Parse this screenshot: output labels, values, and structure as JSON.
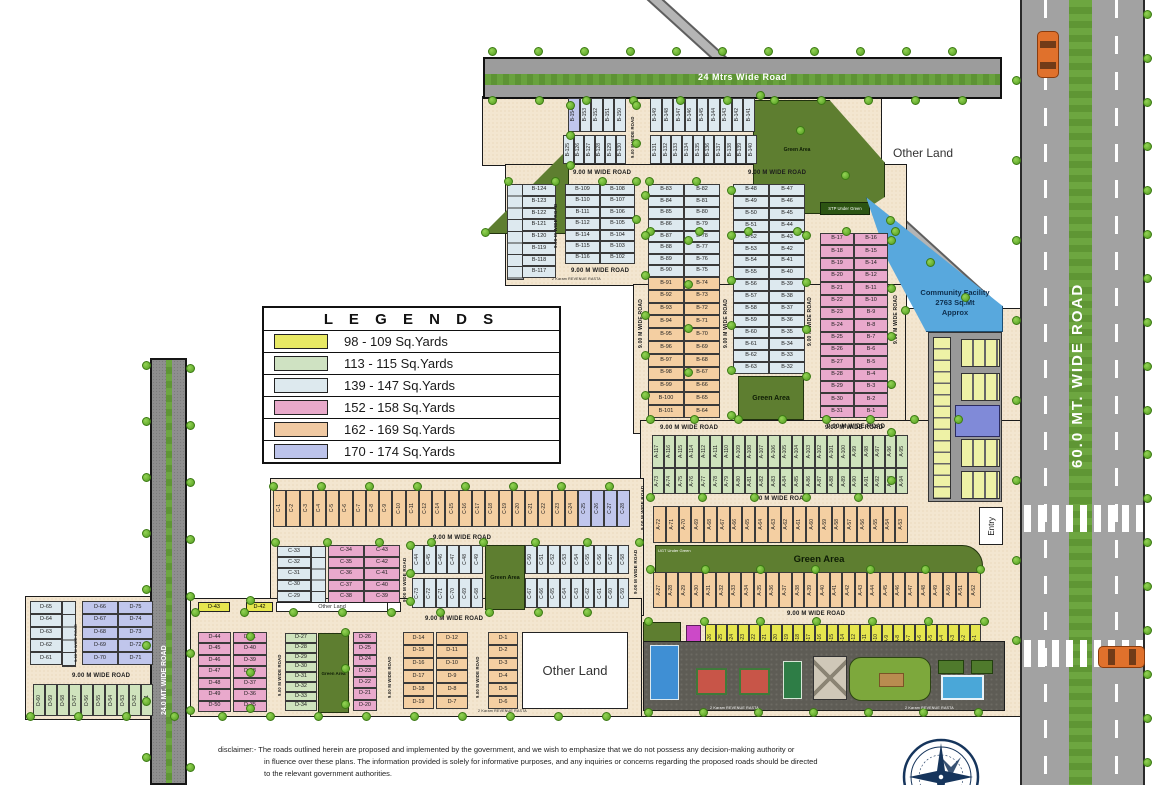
{
  "legend": {
    "title": "L E G E N D S",
    "items": [
      {
        "color": "#e8e964",
        "label": "98 - 109 Sq.Yards"
      },
      {
        "color": "#cfe2c2",
        "label": "113 - 115 Sq.Yards"
      },
      {
        "color": "#dde9ee",
        "label": "139 - 147  Sq.Yards"
      },
      {
        "color": "#e8a9ca",
        "label": "152 - 158  Sq.Yards"
      },
      {
        "color": "#f0c9a2",
        "label": "162 - 169  Sq.Yards"
      },
      {
        "color": "#bcc3ea",
        "label": "170 - 174  Sq.Yards"
      }
    ]
  },
  "roads": {
    "top": "24 Mtrs Wide Road",
    "right": "60.0 MT. WIDE ROAD",
    "left": "24.0 MT. WIDE ROAD",
    "nine_m": "9.00 M WIDE ROAD",
    "rasta": "2 Karam REVENUE RASTA"
  },
  "labels": {
    "other_land": "Other Land",
    "green_area": "Green Area",
    "stp": "STP Under Green",
    "ugt": "UGT Under Green",
    "entry": "Entry",
    "community_l1": "Community Facility",
    "community_l2": "2763 Sq.Mt",
    "community_l3": "Approx"
  },
  "blocks": {
    "b": {
      "row1_left": [
        "B-154",
        "B-153",
        "B-152",
        "B-151",
        "B-150"
      ],
      "row1_right": [
        "B-149",
        "B-148",
        "B-147",
        "B-146",
        "B-145",
        "B-144",
        "B-143",
        "B-142",
        "B-141"
      ],
      "row2_left": [
        "B-125",
        "B-126",
        "B-127",
        "B-128",
        "B-129",
        "B-130"
      ],
      "row2_right": [
        "B-131",
        "B-132",
        "B-133",
        "B-134",
        "B-135",
        "B-136",
        "B-137",
        "B-138",
        "B-139",
        "B-140"
      ],
      "col_outer": [
        "B-124",
        "B-123",
        "B-122",
        "B-121",
        "B-120",
        "B-119",
        "B-118",
        "B-117"
      ],
      "col1_left": [
        "B-109",
        "B-110",
        "B-111",
        "B-112",
        "B-114",
        "B-115",
        "B-116"
      ],
      "col1_right": [
        "B-108",
        "B-107",
        "B-106",
        "B-105",
        "B-104",
        "B-103",
        "B-102"
      ],
      "col2a_left": [
        "B-83",
        "B-84",
        "B-85",
        "B-86",
        "B-87",
        "B-88",
        "B-89",
        "B-90"
      ],
      "col2a_right": [
        "B-82",
        "B-81",
        "B-80",
        "B-79",
        "B-78",
        "B-77",
        "B-76",
        "B-75"
      ],
      "col2b_left": [
        "B-91",
        "B-92",
        "B-93",
        "B-94",
        "B-95",
        "B-96",
        "B-97",
        "B-98",
        "B-99",
        "B-100",
        "B-101"
      ],
      "col2b_right": [
        "B-74",
        "B-73",
        "B-72",
        "B-71",
        "B-70",
        "B-69",
        "B-68",
        "B-67",
        "B-66",
        "B-65",
        "B-64"
      ],
      "col3_left": [
        "B-48",
        "B-49",
        "B-50",
        "B-51",
        "B-52",
        "B-53",
        "B-54",
        "B-55",
        "B-56",
        "B-57",
        "B-58",
        "B-59",
        "B-60",
        "B-61",
        "B-62",
        "B-63"
      ],
      "col3_right": [
        "B-47",
        "B-46",
        "B-45",
        "B-44",
        "B-43",
        "B-42",
        "B-41",
        "B-40",
        "B-39",
        "B-38",
        "B-37",
        "B-36",
        "B-35",
        "B-34",
        "B-33",
        "B-32"
      ],
      "col4_left": [
        "B-17",
        "B-18",
        "B-19",
        "B-20",
        "B-21",
        "B-22",
        "B-23",
        "B-24",
        "B-25",
        "B-26",
        "B-27",
        "B-28",
        "B-29",
        "B-30",
        "B-31"
      ],
      "col4_right": [
        "B-16",
        "B-15",
        "B-14",
        "B-12",
        "B-11",
        "B-10",
        "B-9",
        "B-8",
        "B-7",
        "B-6",
        "B-5",
        "B-4",
        "B-3",
        "B-2",
        "B-1"
      ]
    },
    "a": {
      "green_top": [
        "A-117",
        "A-116",
        "A-115",
        "A-114",
        "A-112",
        "A-111",
        "A-110",
        "A-109",
        "A-108",
        "A-107",
        "A-106",
        "A-105",
        "A-104",
        "A-103",
        "A-102",
        "A-101",
        "A-100",
        "A-99",
        "A-98",
        "A-97",
        "A-96",
        "A-95"
      ],
      "green_bottom": [
        "A-73",
        "A-74",
        "A-75",
        "A-76",
        "A-77",
        "A-78",
        "A-79",
        "A-80",
        "A-81",
        "A-82",
        "A-83",
        "A-84",
        "A-85",
        "A-86",
        "A-87",
        "A-88",
        "A-89",
        "A-90",
        "A-91",
        "A-92",
        "A-93",
        "A-94"
      ],
      "peach_mid": [
        "A-72",
        "A-71",
        "A-70",
        "A-69",
        "A-68",
        "A-67",
        "A-66",
        "A-65",
        "A-64",
        "A-63",
        "A-62",
        "A-61",
        "A-60",
        "A-59",
        "A-58",
        "A-57",
        "A-56",
        "A-55",
        "A-54",
        "A-53"
      ],
      "peach_bottom": [
        "A-27",
        "A-28",
        "A-29",
        "A-30",
        "A-31",
        "A-32",
        "A-33",
        "A-34",
        "A-35",
        "A-36",
        "A-37",
        "A-38",
        "A-39",
        "A-40",
        "A-41",
        "A-42",
        "A-43",
        "A-44",
        "A-45",
        "A-46",
        "A-47",
        "A-48",
        "A-49",
        "A-50",
        "A-51",
        "A-52"
      ],
      "yellow": [
        "A-26",
        "A-25",
        "A-24",
        "A-23",
        "A-22",
        "A-21",
        "A-20",
        "A-19",
        "A-18",
        "A-17",
        "A-16",
        "A-15",
        "A-14",
        "A-12",
        "A-11",
        "A-10",
        "A-9",
        "A-8",
        "A-7",
        "A-6",
        "A-5",
        "A-4",
        "A-3",
        "A-2",
        "A-1"
      ]
    },
    "c": {
      "top_peach": [
        "C-1",
        "C-2",
        "C-3",
        "C-4",
        "C-5",
        "C-6",
        "C-7",
        "C-8",
        "C-9",
        "C-10",
        "C-11",
        "C-12",
        "C-14",
        "C-15",
        "C-16",
        "C-17",
        "C-18",
        "C-19",
        "C-20",
        "C-21",
        "C-22",
        "C-23",
        "C-24"
      ],
      "top_lav": [
        "C-25",
        "C-26",
        "C-27",
        "C-28"
      ],
      "left_col": [
        "C-33",
        "C-32",
        "C-31",
        "C-30",
        "C-29"
      ],
      "pink_left": [
        "C-34",
        "C-35",
        "C-36",
        "C-37",
        "C-38"
      ],
      "pink_right": [
        "C-43",
        "C-42",
        "C-41",
        "C-40",
        "C-39"
      ],
      "s1_top": [
        "C-44",
        "C-45",
        "C-46",
        "C-47",
        "C-48",
        "C-49"
      ],
      "s1_bottom": [
        "C-73",
        "C-72",
        "C-71",
        "C-70",
        "C-69",
        "C-68"
      ],
      "s2_top": [
        "C-50",
        "C-51",
        "C-52",
        "C-53",
        "C-54",
        "C-55",
        "C-56",
        "C-57",
        "C-58"
      ],
      "s2_bottom": [
        "C-67",
        "C-66",
        "C-65",
        "C-64",
        "C-63",
        "C-62",
        "C-61",
        "C-60",
        "C-59"
      ]
    },
    "d": {
      "west_col": [
        "D-65",
        "D-64",
        "D-63",
        "D-62",
        "D-61"
      ],
      "west_left": [
        "D-66",
        "D-67",
        "D-68",
        "D-69",
        "D-70"
      ],
      "west_right": [
        "D-75",
        "D-74",
        "D-73",
        "D-72",
        "D-71"
      ],
      "west_green": [
        "D-60",
        "D-59",
        "D-58",
        "D-57",
        "D-56",
        "D-55",
        "D-54",
        "D-53",
        "D-52",
        "D-51"
      ],
      "yellow1": "D-43",
      "yellow2": "D-42",
      "pink_left": [
        "D-44",
        "D-45",
        "D-46",
        "D-47",
        "D-48",
        "D-49",
        "D-50"
      ],
      "pink_right": [
        "D-41",
        "D-40",
        "D-39",
        "D-38",
        "D-37",
        "D-36",
        "D-35"
      ],
      "green_col": [
        "D-27",
        "D-28",
        "D-29",
        "D-30",
        "D-31",
        "D-32",
        "D-33",
        "D-34"
      ],
      "pink_col": [
        "D-26",
        "D-25",
        "D-24",
        "D-23",
        "D-22",
        "D-21",
        "D-20"
      ],
      "peach_left": [
        "D-14",
        "D-15",
        "D-16",
        "D-17",
        "D-18",
        "D-19"
      ],
      "peach_right": [
        "D-12",
        "D-11",
        "D-10",
        "D-9",
        "D-8",
        "D-7"
      ],
      "peach_col": [
        "D-1",
        "D-2",
        "D-3",
        "D-4",
        "D-5",
        "D-6"
      ]
    }
  },
  "disclaimer": {
    "line1": "disclaimer:- The roads outlined herein are proposed and implemented by the government, and we wish to emphasize that we do not possess any decision-making  authority or",
    "line2": "in fluence over these plans. The information provided is solely for informative purposes, and any inquiries or concerns regarding the proposed roads should be directed",
    "line3": "to the relevant government authorities."
  }
}
